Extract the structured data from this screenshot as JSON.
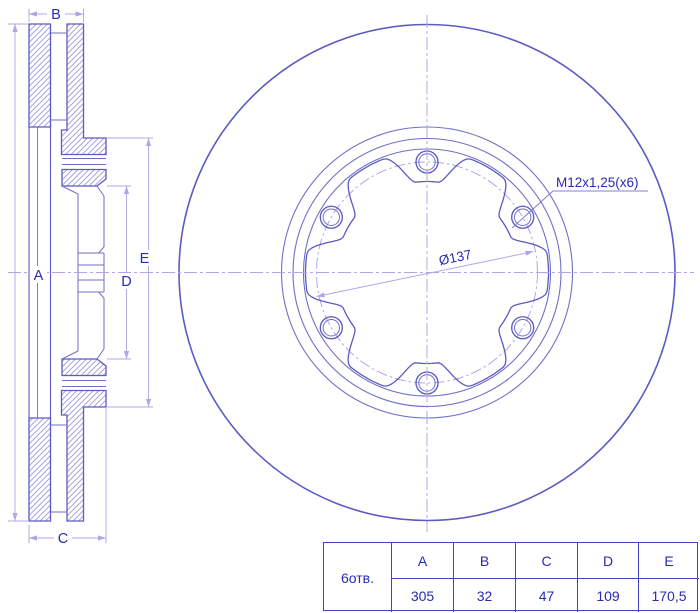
{
  "drawing": {
    "title": "brake-disc-technical-drawing",
    "dim_labels": {
      "A": "A",
      "B": "B",
      "C": "C",
      "D": "D",
      "E": "E"
    },
    "annotations": {
      "thread_spec": "M12x1,25(x6)",
      "bolt_circle_diameter": "Ø137"
    },
    "colors": {
      "outline": "#5b5bc2",
      "thin": "#6f6fc9",
      "hatch": "#9a9ada",
      "violet": "#b4a4e6",
      "text": "#2a2ab2",
      "leader": "#8080d2",
      "table_border": "#4343bd",
      "background": "#ffffff"
    }
  },
  "table": {
    "row_label": "6отв.",
    "columns": [
      "A",
      "B",
      "C",
      "D",
      "E"
    ],
    "values": [
      "305",
      "32",
      "47",
      "109",
      "170,5"
    ]
  }
}
